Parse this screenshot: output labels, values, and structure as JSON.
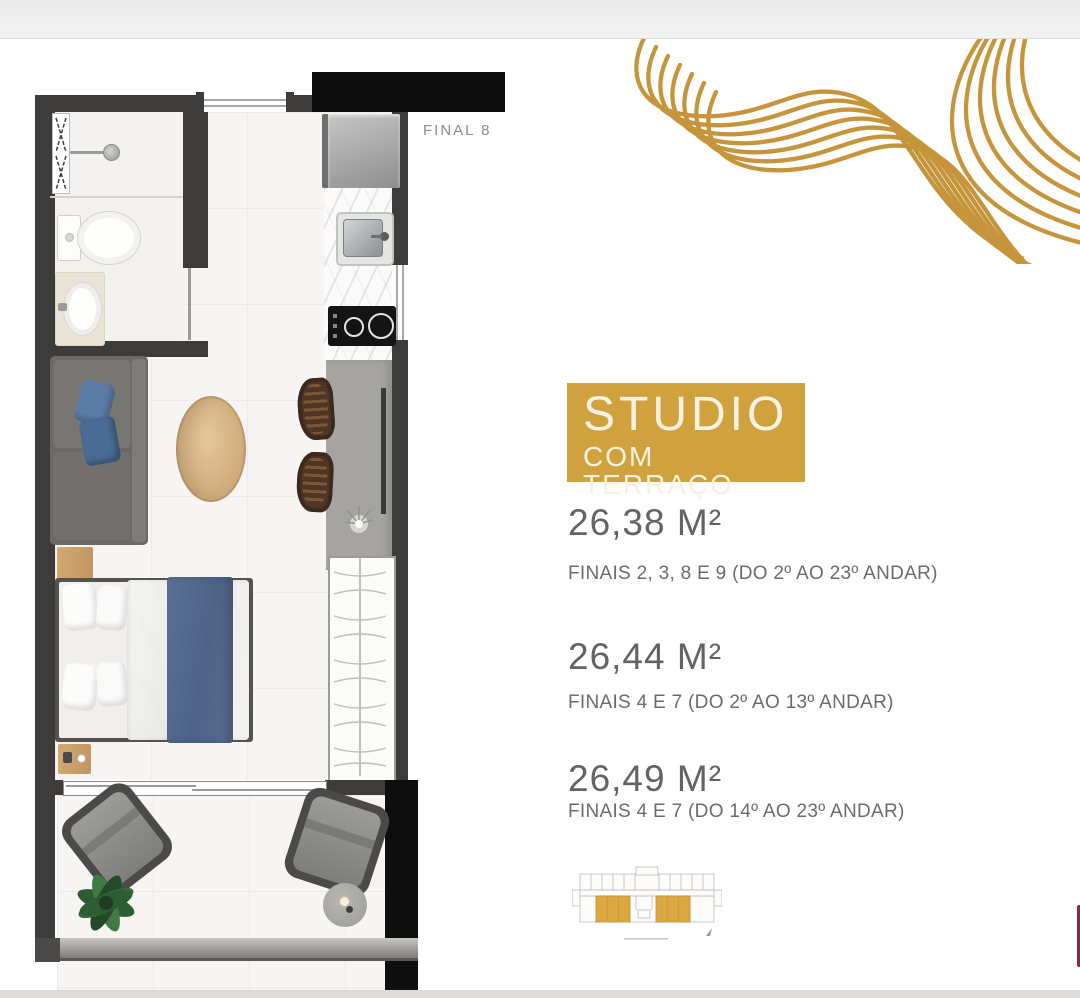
{
  "colors": {
    "accent_gold": "#CFA23E",
    "wave_gold": "#C6953B",
    "keyplan_highlight": "#DCA73E",
    "wall_dark": "#3D3C3B",
    "text_gray": "#636367",
    "edge_maroon": "#8D2543"
  },
  "floor_plan": {
    "unit_label": "FINAL 8"
  },
  "listing": {
    "badge": {
      "title": "STUDIO",
      "subtitle": "COM TERRAÇO"
    },
    "variants": [
      {
        "area": "26,38 M²",
        "floors": "FINAIS 2, 3, 8 E 9 (DO 2º AO 23º ANDAR)"
      },
      {
        "area": "26,44 M²",
        "floors": "FINAIS 4 E 7 (DO 2º AO 13º ANDAR)"
      },
      {
        "area": "26,49 M²",
        "floors": "FINAIS 4 E 7 (DO 14º AO 23º ANDAR)"
      }
    ]
  }
}
